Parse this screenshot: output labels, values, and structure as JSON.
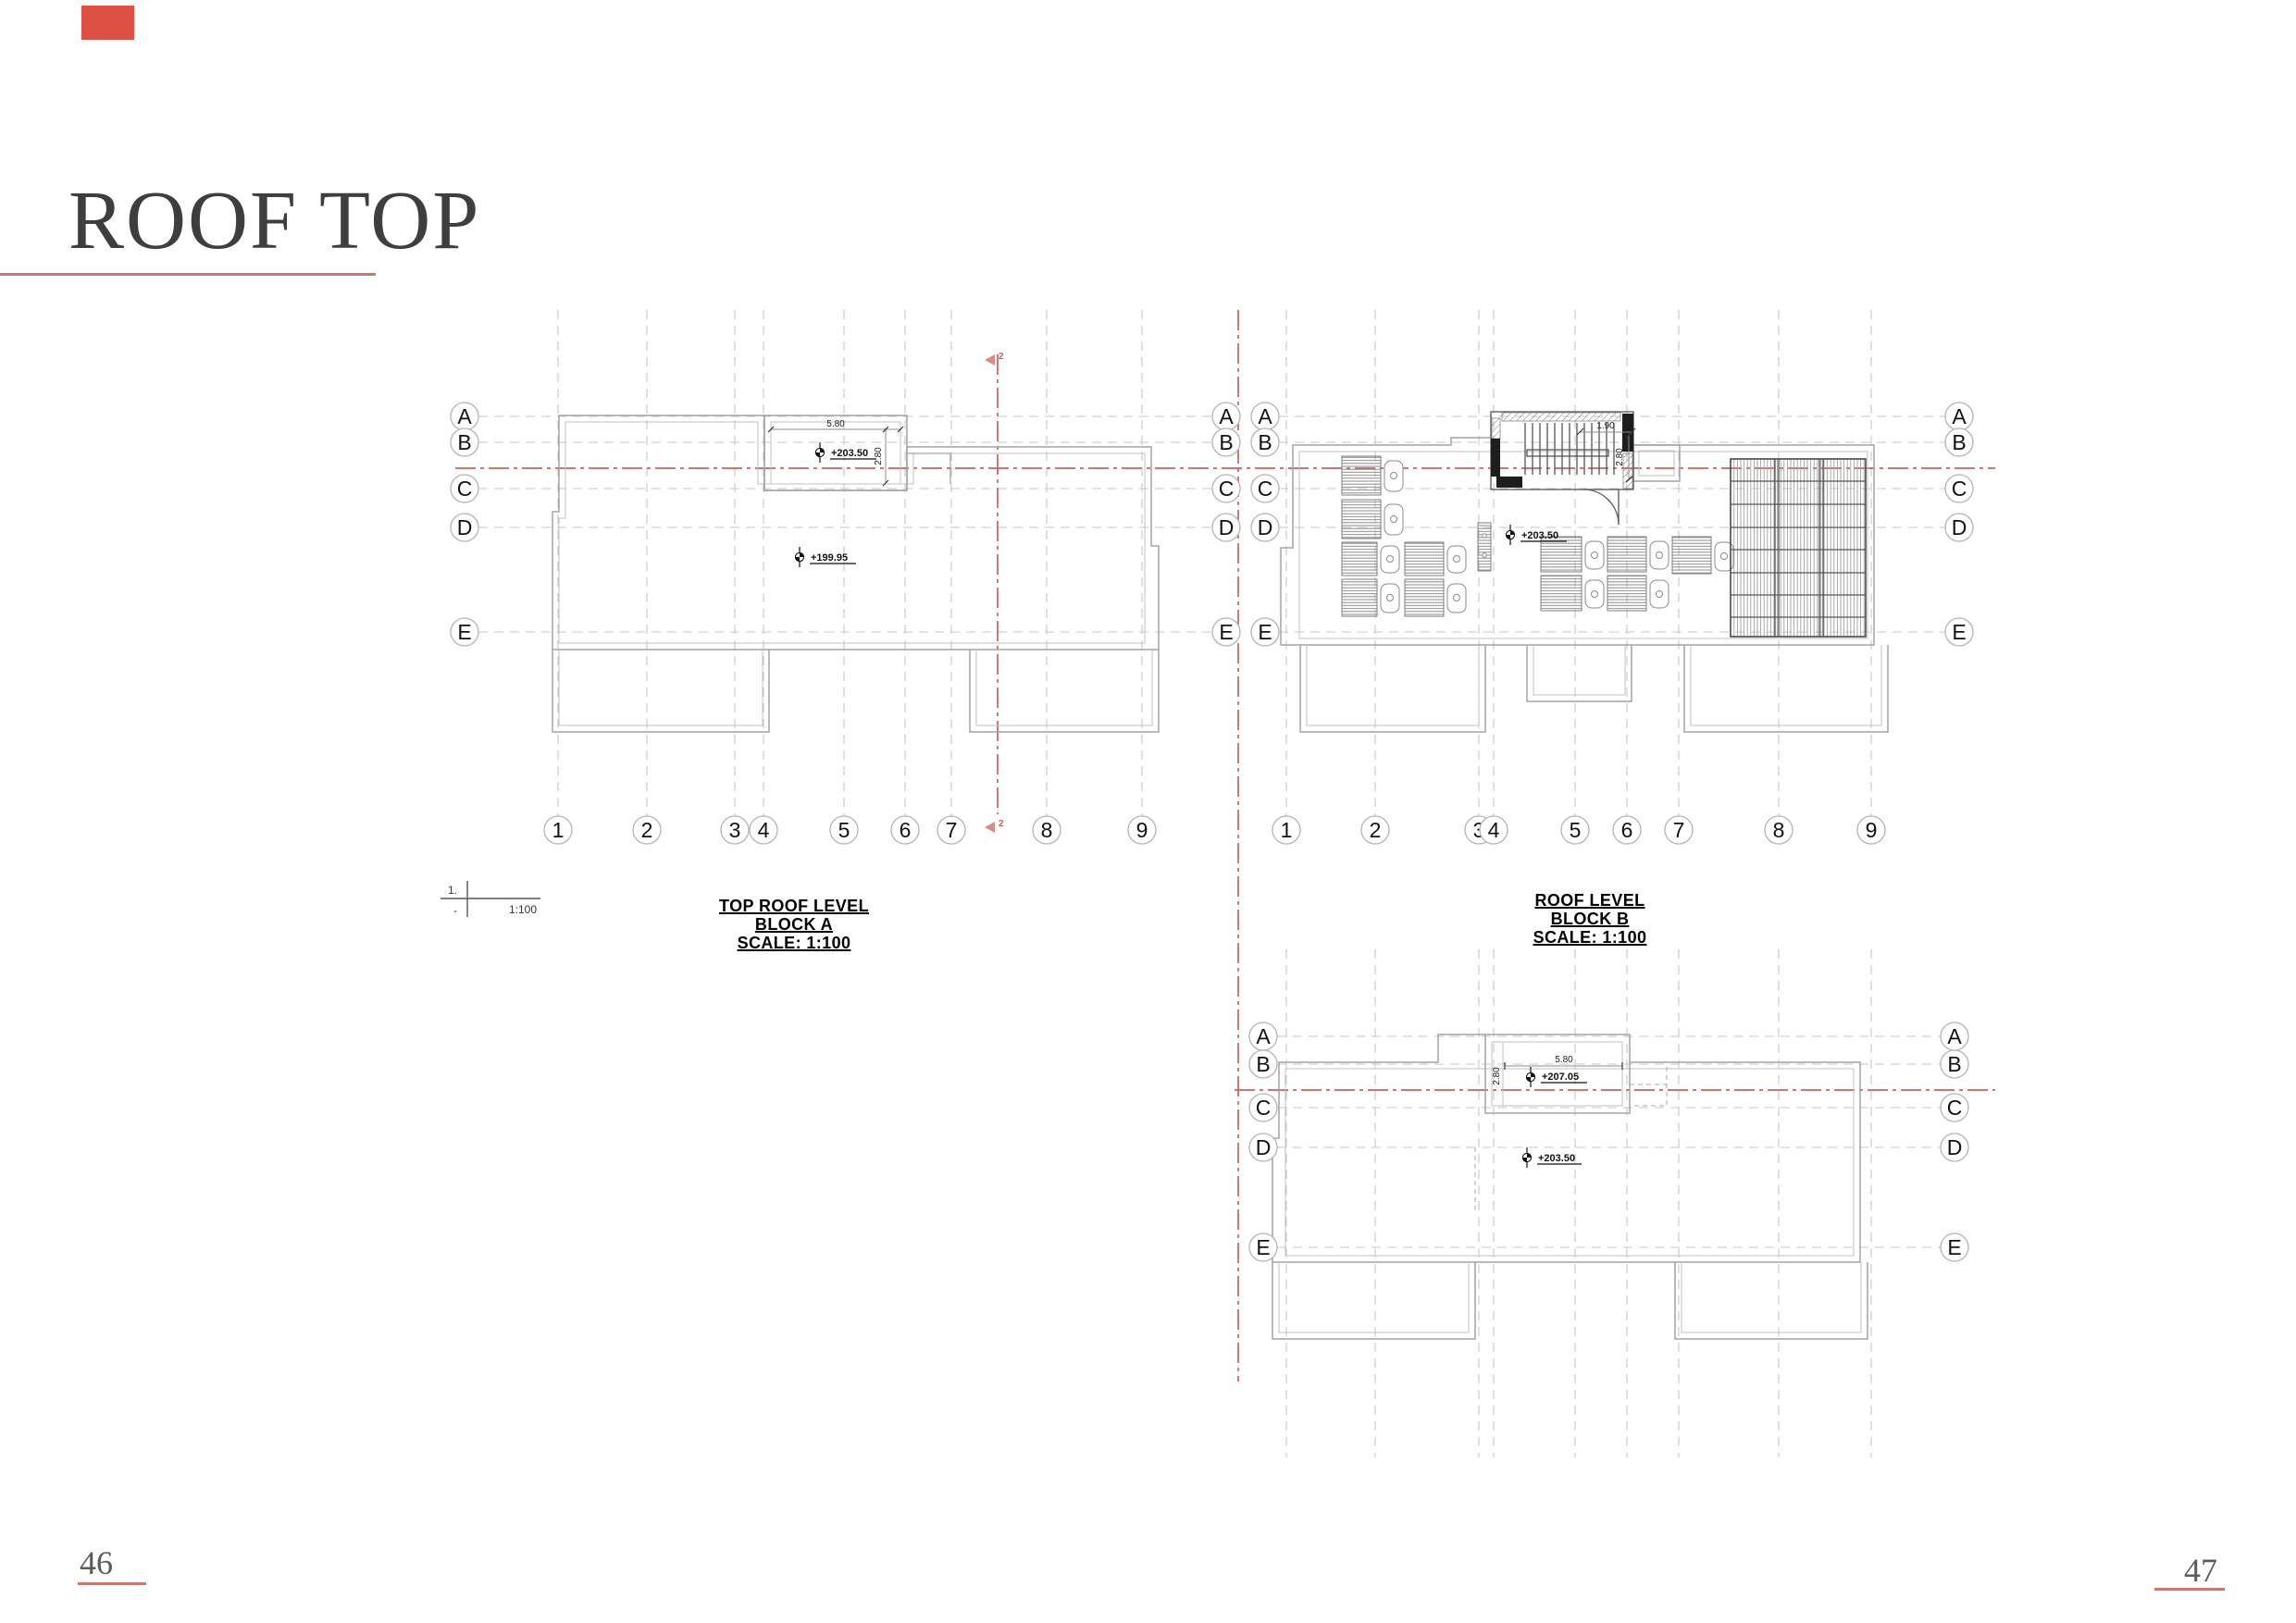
{
  "page": {
    "title": "ROOF TOP",
    "left_page_number": "46",
    "right_page_number": "47"
  },
  "colors": {
    "accent_red": "#c9776f",
    "drawing_red": "#c4645e",
    "corner_red": "#de5044"
  },
  "scale_bar": {
    "numerator": "1.",
    "denominator": "-",
    "ratio": "1:100"
  },
  "grid": {
    "rows": [
      "A",
      "B",
      "C",
      "D",
      "E"
    ],
    "cols": [
      "1",
      "2",
      "3",
      "4",
      "5",
      "6",
      "7",
      "8",
      "9"
    ]
  },
  "section_marker": {
    "number": "2"
  },
  "plan_a": {
    "title": [
      "TOP ROOF LEVEL",
      "BLOCK A",
      "SCALE: 1:100"
    ],
    "penthouse_level": "+203.50",
    "roof_level": "+199.95",
    "penthouse_width": "5.80",
    "penthouse_depth": "2.80"
  },
  "plan_b": {
    "title": [
      "ROOF LEVEL",
      "BLOCK B",
      "SCALE: 1:100"
    ],
    "roof_level": "+203.50",
    "stair_width": "1.90",
    "stair_depth": "2.80"
  },
  "plan_c": {
    "penthouse_level": "+207.05",
    "roof_level": "+203.50",
    "penthouse_width": "5.80",
    "penthouse_depth": "2.80"
  }
}
